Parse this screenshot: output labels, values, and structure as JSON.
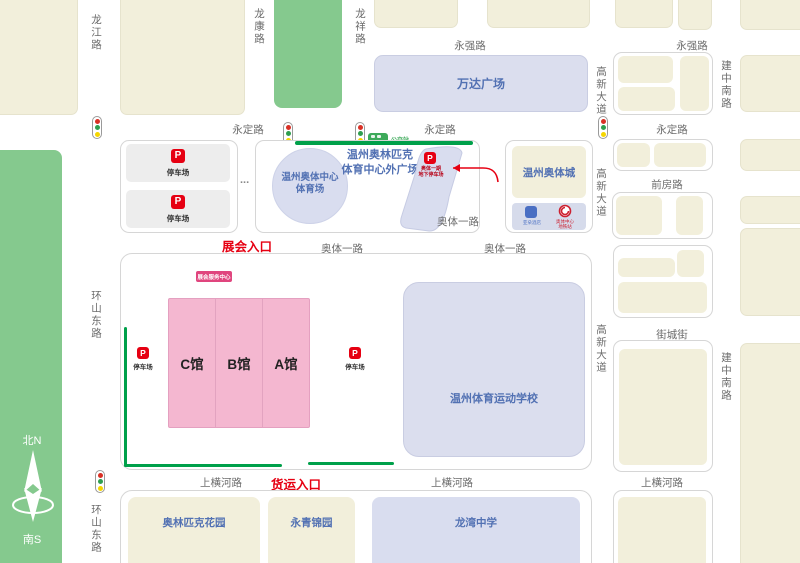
{
  "colors": {
    "cream_block": "#f2efdb",
    "green_block": "#85c98e",
    "lavender_block": "#dbdeee",
    "blue_road_bar": "#a6c9e6",
    "pink_hall": "#f4b7d0",
    "accent_red": "#e60012",
    "service_badge_magenta": "#e0457e",
    "route_green": "#00a04a",
    "place_text_blue": "#5271b3",
    "road_text_gray": "#6b6b6b"
  },
  "compass": {
    "north": "北N",
    "south": "南S"
  },
  "roads": {
    "longjiang": "龙江路",
    "longkang": "龙康路",
    "longxiang": "龙祥路",
    "yongqiang": "永强路",
    "yongding": "永定路",
    "gaoxin": "高新大道",
    "jianzhong": "建中南路",
    "qianfang": "前房路",
    "aoti": "奥体一路",
    "jiecheng": "街城街",
    "shanghenghe": "上横河路",
    "huanshan": "环山东路"
  },
  "places": {
    "wanda": "万达广场",
    "stadium_line1": "温州奥体中心",
    "stadium_line2": "体育场",
    "plaza_line1": "温州奥林匹克",
    "plaza_line2": "体育中心外广场",
    "aoticheng": "温州奥体城",
    "sports_school": "温州体育运动学校",
    "olympic_garden": "奥林匹克花园",
    "yongqing_garden": "永青锦园",
    "longwan_school": "龙湾中学"
  },
  "venue": {
    "hall_c": "C馆",
    "hall_b": "B馆",
    "hall_a": "A馆",
    "expo_entrance": "展会入口",
    "freight_entrance": "货运入口",
    "service_center": "展会服务中心",
    "parking_label": "停车场",
    "p": "P",
    "underground_line1": "奥体一期",
    "underground_line2": "地下停车场",
    "ellipsis": "..."
  },
  "pois": {
    "bus_stop": "公交站",
    "hotel": "亚朵酒店",
    "metro_line1": "奥体中心",
    "metro_line2": "地铁站"
  }
}
